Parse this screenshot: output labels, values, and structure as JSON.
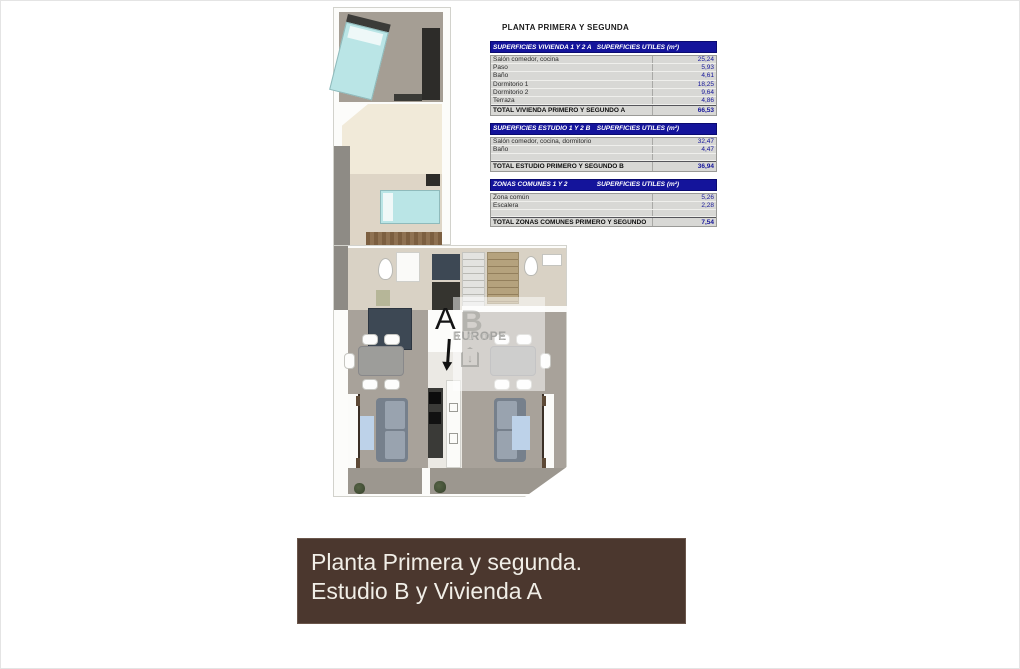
{
  "title": "PLANTA PRIMERA Y SEGUNDA",
  "tables": [
    {
      "header_left": "SUPERFICIES VIVIENDA 1 Y 2 A",
      "header_right": "SUPERFICIES UTILES  (m²)",
      "rows": [
        {
          "label": "Salón comedor, cocina",
          "value": "25,24"
        },
        {
          "label": "Paso",
          "value": "5,93"
        },
        {
          "label": "Baño",
          "value": "4,61"
        },
        {
          "label": "Dormitorio 1",
          "value": "18,25"
        },
        {
          "label": "Dormitorio 2",
          "value": "9,64"
        },
        {
          "label": "Terraza",
          "value": "4,86"
        }
      ],
      "blank_row": false,
      "total_label": "TOTAL VIVIENDA PRIMERO Y SEGUNDO A",
      "total_value": "66,53"
    },
    {
      "header_left": "SUPERFICIES ESTUDIO 1 Y 2 B",
      "header_right": "SUPERFICIES UTILES  (m²)",
      "rows": [
        {
          "label": "Salón comedor, cocina, dormitorio",
          "value": "32,47"
        },
        {
          "label": "Baño",
          "value": "4,47"
        }
      ],
      "blank_row": true,
      "total_label": "TOTAL ESTUDIO PRIMERO Y SEGUNDO B",
      "total_value": "36,94"
    },
    {
      "header_left": "ZONAS COMUNES 1 Y 2",
      "header_right": "SUPERFICIES UTILES  (m²)",
      "rows": [
        {
          "label": "Zona común",
          "value": "5,26"
        },
        {
          "label": "Escalera",
          "value": "2,28"
        }
      ],
      "blank_row": true,
      "total_label": "TOTAL ZONAS COMUNES PRIMERO Y SEGUNDO",
      "total_value": "7,54"
    }
  ],
  "caption": {
    "line1": "Planta Primera y segunda.",
    "line2": "Estudio B y Vivienda A"
  },
  "plan": {
    "unit_label_a": "A",
    "watermark_letter": "B",
    "watermark_brand": "EUROPE",
    "watermark_brand2": "h o m e",
    "watermark_arrow": "↓"
  },
  "colors": {
    "table_header_bg": "#14149b",
    "table_value_text": "#16169b",
    "caption_bg": "#4b372e",
    "caption_text": "#f1eee7",
    "bed_cover": "#bae5e6",
    "carpet_gray": "#a8a29a",
    "terrace_cream": "#f1ead9"
  }
}
